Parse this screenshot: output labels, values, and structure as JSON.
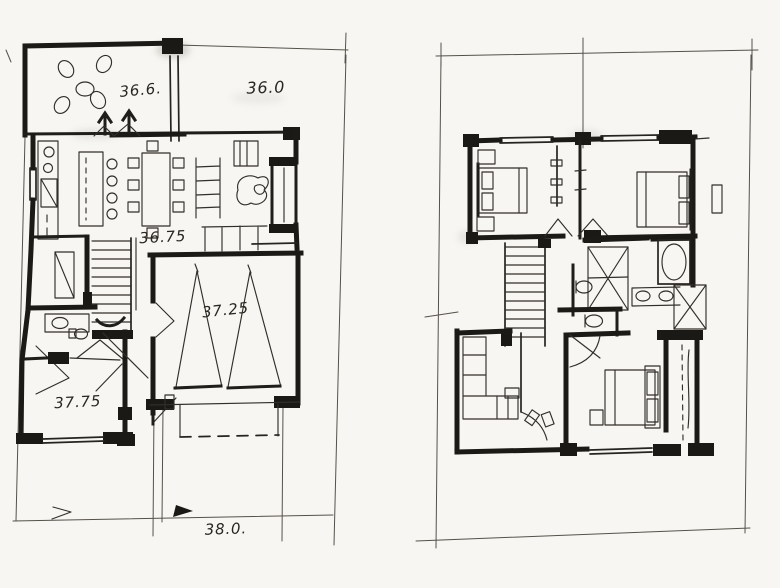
{
  "document": {
    "kind": "hand-drawn architectural floor plan sketch",
    "medium": "black ink on white paper",
    "paper_color": "#f7f6f2",
    "ink_color": "#1c1a17"
  },
  "labels": {
    "patio": "36.6.",
    "front_yard": "36.0",
    "living": "36.75",
    "garage": "37.25",
    "lower_room": "37.75",
    "street": "38.0."
  },
  "plans": [
    {
      "name": "ground floor plan",
      "side": "left",
      "spot_elevations": [
        "36.6.",
        "36.0",
        "36.75",
        "37.25",
        "37.75",
        "38.0."
      ],
      "rooms": [
        "patio with round table and four chairs",
        "open kitchen with counter, island and stools",
        "dining table with eight chairs",
        "living area with shelf, armchair and fireplace unit",
        "staircase",
        "powder room with vanity and toilet",
        "room at lower left",
        "double garage with two car markers and dashed door",
        "driveway and site boundary"
      ]
    },
    {
      "name": "upper floor plan",
      "side": "right",
      "spot_elevations": [],
      "rooms": [
        "bedroom top-left with bed and side tables",
        "wardrobe closet between bedrooms",
        "bedroom top-right with bed",
        "staircase",
        "bathroom suite with tub, double vanity and two toilets",
        "linen cupboards marked with X",
        "sitting area with L-shaped sofa",
        "bedroom bottom-right with bed and built-in wardrobe"
      ]
    }
  ]
}
